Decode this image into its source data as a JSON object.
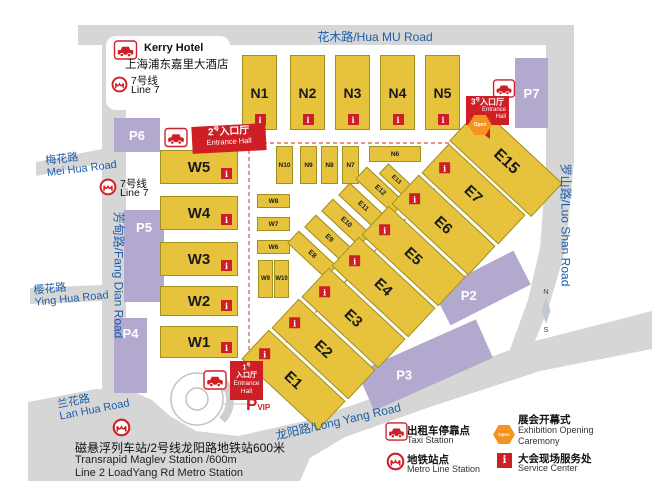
{
  "hotel": {
    "name_en": "Kerry Hotel",
    "name_cn": "上海浦东嘉里大酒店",
    "metro_cn": "7号线",
    "metro_en": "Line 7"
  },
  "metro7": {
    "cn": "7号线",
    "en": "Line 7"
  },
  "roads": {
    "hua_mu": "花木路/Hua MU Road",
    "luo_shan": "罗山路/Luo Shan Road",
    "fang_dian": "芳甸路/Fang Dian Road",
    "long_yang": "龙阳路/Long Yang Road",
    "mei_hua_cn": "梅花路",
    "mei_hua_en": "Mei Hua Road",
    "ying_hua_cn": "樱花路",
    "ying_hua_en": "Ying Hua Road",
    "lan_hua_cn": "兰花路",
    "lan_hua_en": "Lan Hua Road"
  },
  "halls": {
    "north": [
      "N1",
      "N2",
      "N3",
      "N4",
      "N5"
    ],
    "north_small": [
      "N10",
      "N9",
      "N8",
      "N7",
      "N6"
    ],
    "west": [
      "W5",
      "W4",
      "W3",
      "W2",
      "W1"
    ],
    "west_small": [
      "W8",
      "W7",
      "W6",
      "W9",
      "W10"
    ],
    "east": [
      "E1",
      "E2",
      "E3",
      "E4",
      "E5",
      "E6",
      "E7",
      "E15"
    ],
    "east_small": [
      "E8",
      "E9",
      "E10",
      "E11",
      "E12",
      "E13"
    ]
  },
  "parking": {
    "p2": "P2",
    "p3": "P3",
    "p4": "P4",
    "p5": "P5",
    "p6": "P6",
    "p7": "P7",
    "vip_p": "P",
    "vip_sub": "VIP"
  },
  "entrances": {
    "no1": {
      "num": "1",
      "sup": "号",
      "cn": "入口厅",
      "en1": "Entrance",
      "en2": "Hall"
    },
    "no2": {
      "num": "2",
      "sup": "号",
      "cn": "入口厅",
      "en": "Entrance Hall"
    },
    "no3": {
      "num": "3",
      "sup": "号",
      "cn": "入口厅",
      "en1": "Entrance",
      "en2": "Hall"
    }
  },
  "badges": {
    "info": "i",
    "open": "Open"
  },
  "compass": {
    "n": "N",
    "s": "S"
  },
  "legend": {
    "taxi_cn": "出租车停靠点",
    "taxi_en": "Taxi Station",
    "metro_cn": "地铁站点",
    "metro_en": "Metro Line Station",
    "open_cn": "展会开幕式",
    "open_en1": "Exhibition Opening",
    "open_en2": "Caremony",
    "service_cn": "大会现场服务处",
    "service_en": "Service Center"
  },
  "footer": {
    "line1": "磁悬浮列车站/2号线龙阳路地铁站600米",
    "line2": "Transrapid Maglev Station /600m",
    "line3": "Line 2 LoadYang Rd Metro Station"
  },
  "colors": {
    "hall": "#e7c33d",
    "parking": "#b3a8cd",
    "red": "#ce1f26",
    "road": "#d6d6d6",
    "road_text": "#1d5ea9",
    "open_orange": "#f6921e"
  }
}
